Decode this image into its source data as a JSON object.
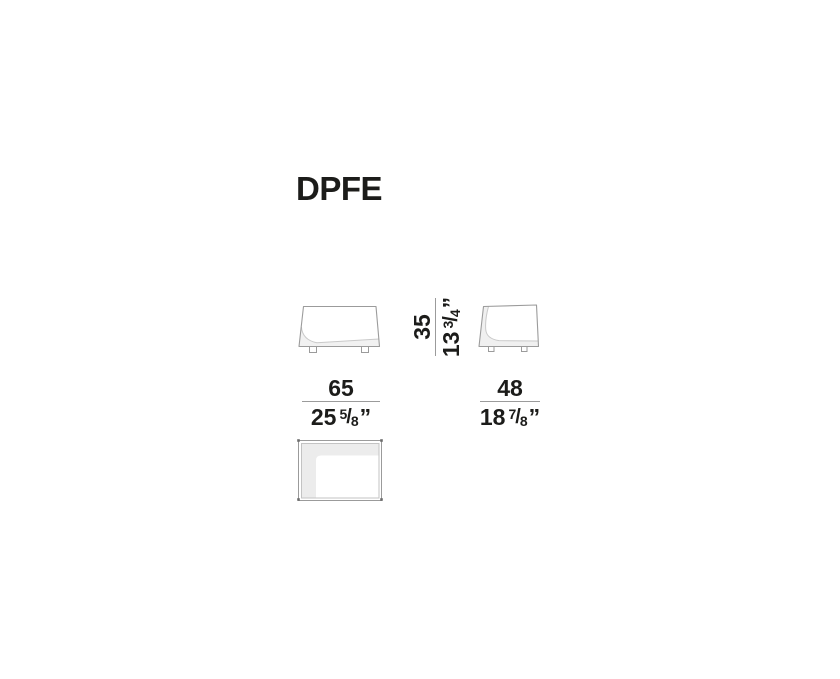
{
  "title": "DPFE",
  "dimensions": {
    "width": {
      "cm": "65",
      "inch_whole": "25",
      "frac_num": "5",
      "frac_slash": "/",
      "frac_den": "8",
      "unit_mark": "”"
    },
    "depth": {
      "cm": "48",
      "inch_whole": "18",
      "frac_num": "7",
      "frac_slash": "/",
      "frac_den": "8",
      "unit_mark": "”"
    },
    "height": {
      "cm": "35",
      "inch_whole": "13",
      "frac_num": "3",
      "frac_slash": "/",
      "frac_den": "4",
      "unit_mark": "”"
    }
  },
  "colors": {
    "text": "#1c1c1a",
    "outline": "#9b9b9b",
    "inner_line": "#c9c9c9",
    "shading": "#f0f0f0",
    "top_view_fill": "#ececec",
    "fraction_bar": "#9b9b9b",
    "background": "#ffffff"
  }
}
